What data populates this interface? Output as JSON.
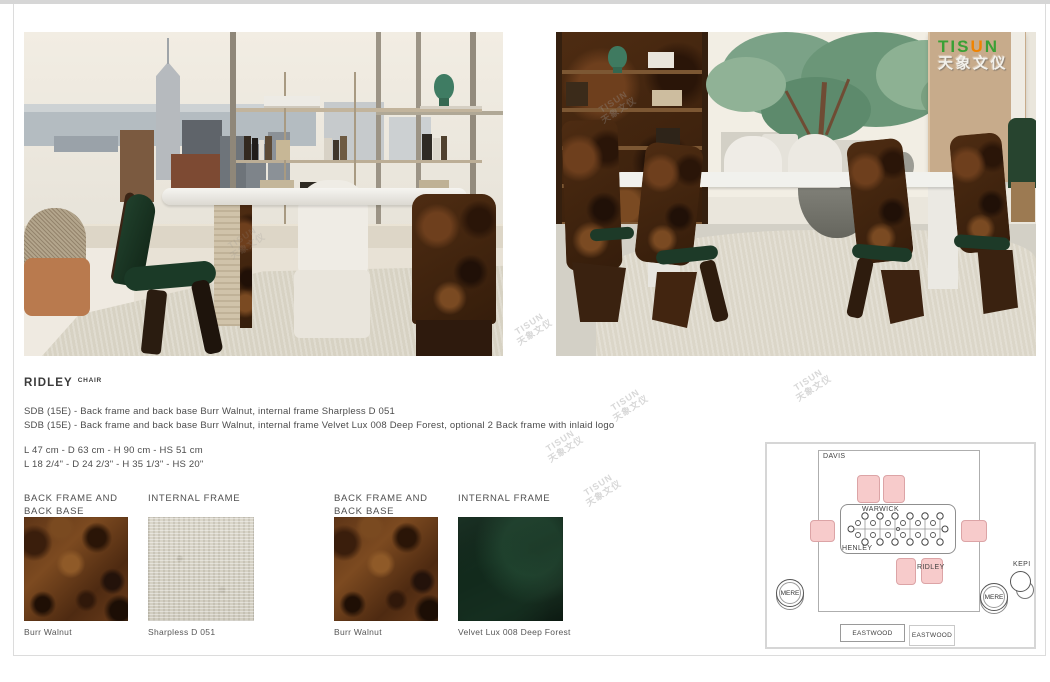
{
  "watermark": {
    "line1": "TISUN",
    "line2": "天象文仪"
  },
  "logo": {
    "green_part": "TIS",
    "orange_part": "U",
    "green_part2": "N",
    "chinese": "天象文仪",
    "green": "#3aa035",
    "orange": "#f08300"
  },
  "product": {
    "name": "RIDLEY",
    "category": "CHAIR",
    "description_line1": "SDB (15E) - Back frame and back base Burr Walnut, internal frame Sharpless D 051",
    "description_line2": "SDB (15E) - Back frame and back base Burr Walnut, internal frame Velvet Lux 008 Deep Forest, optional 2 Back frame with inlaid logo",
    "dimensions_metric": "L 47 cm - D 63 cm - H 90 cm - HS 51 cm",
    "dimensions_imperial": "L 18 2/4\" - D 24 2/3\" - H 35 1/3\" - HS 20\""
  },
  "swatches": [
    {
      "header": "BACK FRAME AND BACK BASE",
      "caption": "Burr Walnut"
    },
    {
      "header": "INTERNAL FRAME",
      "caption": "Sharpless D 051"
    },
    {
      "header": "BACK FRAME AND BACK BASE",
      "caption": "Burr Walnut"
    },
    {
      "header": "INTERNAL FRAME",
      "caption": "Velvet Lux 008 Deep Forest"
    }
  ],
  "floorplan": {
    "rug": "DAVIS",
    "table": "WARWICK",
    "table2": "HENLEY",
    "chair": "RIDLEY",
    "side_table": "MERE",
    "corner_table": "KEPI",
    "console": "EASTWOOD",
    "colors": {
      "chair_fill": "#f7cbcb",
      "chair_border": "#dca4a6"
    }
  }
}
